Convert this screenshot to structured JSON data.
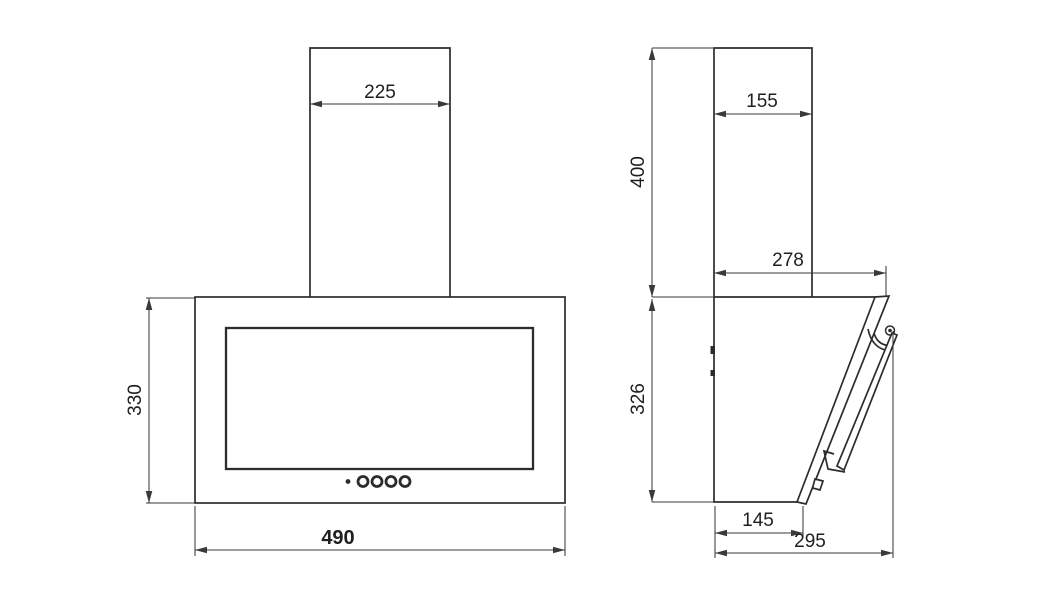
{
  "drawing": {
    "front_view": {
      "chimney_width_mm": "225",
      "body_height_mm": "330",
      "body_width_mm": "490"
    },
    "side_view": {
      "chimney_depth_mm": "155",
      "chimney_height_mm": "400",
      "upper_depth_mm": "278",
      "body_height_mm": "326",
      "bottom_depth_mm": "145",
      "overall_depth_mm": "295"
    },
    "colors": {
      "background": "#ffffff",
      "outline": "#2c2c2c",
      "dimension_lines": "#3a3a3a",
      "text": "#1f1f1f"
    }
  }
}
